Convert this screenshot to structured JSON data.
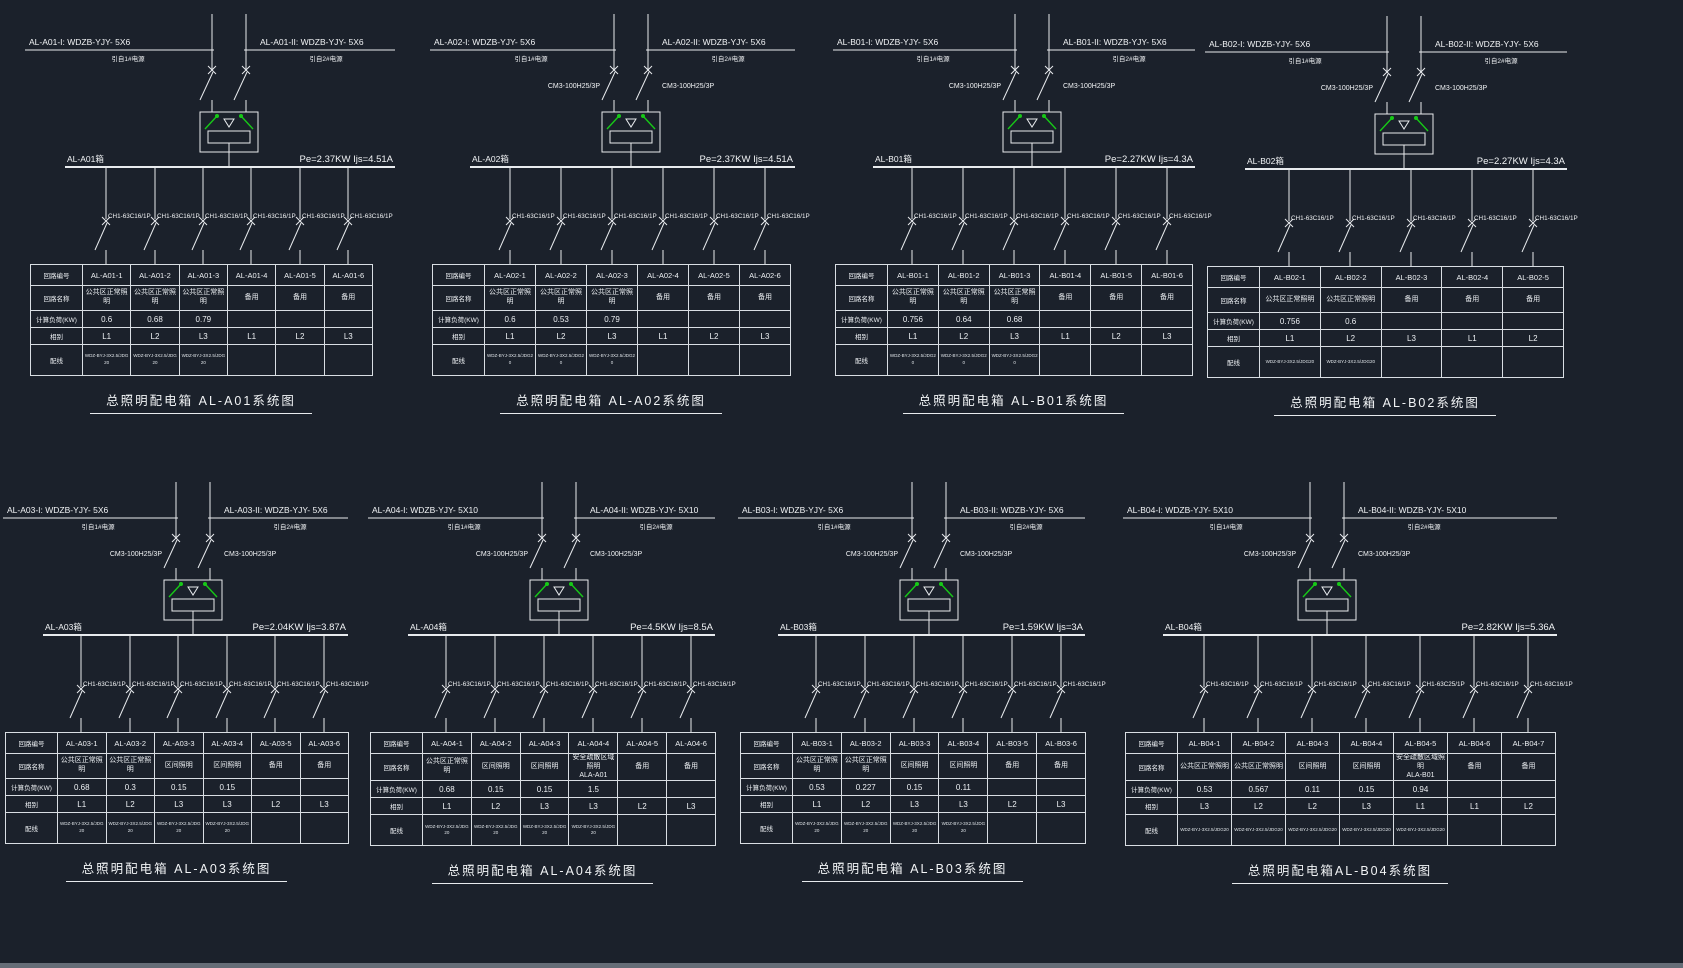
{
  "app": {
    "background": "#1b212b",
    "line_color": "#e8ebee",
    "text_color": "#f2f4f6",
    "switch_green": "#17c917"
  },
  "source_labels": {
    "left": "引自1#电源",
    "right": "引自2#电源"
  },
  "table_row_labels": {
    "circuit_no": "回路编号",
    "circuit_name": "回路名称",
    "load": "计算负荷(KW)",
    "phase": "相别",
    "wiring": "配线"
  },
  "panels": [
    {
      "id": "AL-A01",
      "title": "总照明配电箱 AL-A01系统图",
      "feeder_left": "AL-A01-I: WDZB-YJY- 5X6",
      "feeder_right": "AL-A01-II: WDZB-YJY- 5X6",
      "incoming_breaker": "",
      "bus_label": "AL-A01箱",
      "rating": "Pe=2.37KW Ijs=4.51A",
      "circuits": [
        "AL-A01-1",
        "AL-A01-2",
        "AL-A01-3",
        "AL-A01-4",
        "AL-A01-5",
        "AL-A01-6"
      ],
      "names": [
        "公共区正常照明",
        "公共区正常照明",
        "公共区正常照明",
        "备用",
        "备用",
        "备用"
      ],
      "loads": [
        "0.6",
        "0.68",
        "0.79",
        "",
        "",
        ""
      ],
      "phases": [
        "L1",
        "L2",
        "L3",
        "L1",
        "L2",
        "L3"
      ],
      "wiring": [
        "WDZ-BYJ-3X2.5/JDG20",
        "WDZ-BYJ-3X2.5/JDG20",
        "WDZ-BYJ-3X2.5/JDG20",
        "",
        "",
        ""
      ],
      "branch_breakers": [
        "CH1-63C16/1P",
        "CH1-63C16/1P",
        "CH1-63C16/1P",
        "CH1-63C16/1P",
        "CH1-63C16/1P",
        "CH1-63C16/1P"
      ]
    },
    {
      "id": "AL-A02",
      "title": "总照明配电箱 AL-A02系统图",
      "feeder_left": "AL-A02-I: WDZB-YJY- 5X6",
      "feeder_right": "AL-A02-II: WDZB-YJY- 5X6",
      "incoming_breaker": "CM3-100H25/3P",
      "bus_label": "AL-A02箱",
      "rating": "Pe=2.37KW Ijs=4.51A",
      "circuits": [
        "AL-A02-1",
        "AL-A02-2",
        "AL-A02-3",
        "AL-A02-4",
        "AL-A02-5",
        "AL-A02-6"
      ],
      "names": [
        "公共区正常照明",
        "公共区正常照明",
        "公共区正常照明",
        "备用",
        "备用",
        "备用"
      ],
      "loads": [
        "0.6",
        "0.53",
        "0.79",
        "",
        "",
        ""
      ],
      "phases": [
        "L1",
        "L2",
        "L3",
        "L1",
        "L2",
        "L3"
      ],
      "wiring": [
        "WDZ-BYJ-3X2.5/JDG20",
        "WDZ-BYJ-3X2.5/JDG20",
        "WDZ-BYJ-3X2.5/JDG20",
        "",
        "",
        ""
      ],
      "branch_breakers": [
        "CH1-63C16/1P",
        "CH1-63C16/1P",
        "CH1-63C16/1P",
        "CH1-63C16/1P",
        "CH1-63C16/1P",
        "CH1-63C16/1P"
      ]
    },
    {
      "id": "AL-B01",
      "title": "总照明配电箱 AL-B01系统图",
      "feeder_left": "AL-B01-I: WDZB-YJY- 5X6",
      "feeder_right": "AL-B01-II: WDZB-YJY- 5X6",
      "incoming_breaker": "CM3-100H25/3P",
      "bus_label": "AL-B01箱",
      "rating": "Pe=2.27KW Ijs=4.3A",
      "circuits": [
        "AL-B01-1",
        "AL-B01-2",
        "AL-B01-3",
        "AL-B01-4",
        "AL-B01-5",
        "AL-B01-6"
      ],
      "names": [
        "公共区正常照明",
        "公共区正常照明",
        "公共区正常照明",
        "备用",
        "备用",
        "备用"
      ],
      "loads": [
        "0.756",
        "0.64",
        "0.68",
        "",
        "",
        ""
      ],
      "phases": [
        "L1",
        "L2",
        "L3",
        "L1",
        "L2",
        "L3"
      ],
      "wiring": [
        "WDZ-BYJ-3X2.5/JDG20",
        "WDZ-BYJ-3X2.5/JDG20",
        "WDZ-BYJ-3X2.5/JDG20",
        "",
        "",
        ""
      ],
      "branch_breakers": [
        "CH1-63C16/1P",
        "CH1-63C16/1P",
        "CH1-63C16/1P",
        "CH1-63C16/1P",
        "CH1-63C16/1P",
        "CH1-63C16/1P"
      ]
    },
    {
      "id": "AL-B02",
      "title": "总照明配电箱 AL-B02系统图",
      "feeder_left": "AL-B02-I: WDZB-YJY- 5X6",
      "feeder_right": "AL-B02-II: WDZB-YJY- 5X6",
      "incoming_breaker": "CM3-100H25/3P",
      "bus_label": "AL-B02箱",
      "rating": "Pe=2.27KW Ijs=4.3A",
      "circuits": [
        "AL-B02-1",
        "AL-B02-2",
        "AL-B02-3",
        "AL-B02-4",
        "AL-B02-5"
      ],
      "names": [
        "公共区正常照明",
        "公共区正常照明",
        "备用",
        "备用",
        "备用"
      ],
      "loads": [
        "0.756",
        "0.6",
        "",
        "",
        ""
      ],
      "phases": [
        "L1",
        "L2",
        "L3",
        "L1",
        "L2"
      ],
      "wiring": [
        "WDZ-BYJ-3X2.5/JDG20",
        "WDZ-BYJ-3X2.5/JDG20",
        "",
        "",
        ""
      ],
      "branch_breakers": [
        "CH1-63C16/1P",
        "CH1-63C16/1P",
        "CH1-63C16/1P",
        "CH1-63C16/1P",
        "CH1-63C16/1P"
      ]
    },
    {
      "id": "AL-A03",
      "title": "总照明配电箱 AL-A03系统图",
      "feeder_left": "AL-A03-I: WDZB-YJY- 5X6",
      "feeder_right": "AL-A03-II: WDZB-YJY- 5X6",
      "incoming_breaker": "CM3-100H25/3P",
      "bus_label": "AL-A03箱",
      "rating": "Pe=2.04KW Ijs=3.87A",
      "circuits": [
        "AL-A03-1",
        "AL-A03-2",
        "AL-A03-3",
        "AL-A03-4",
        "AL-A03-5",
        "AL-A03-6"
      ],
      "names": [
        "公共区正常照明",
        "公共区正常照明",
        "区间照明",
        "区间照明",
        "备用",
        "备用"
      ],
      "loads": [
        "0.68",
        "0.3",
        "0.15",
        "0.15",
        "",
        ""
      ],
      "phases": [
        "L1",
        "L2",
        "L3",
        "L3",
        "L2",
        "L3"
      ],
      "wiring": [
        "WDZ-BYJ-3X2.5/JDG20",
        "WDZ-BYJ-3X2.5/JDG20",
        "WDZ-BYJ-3X2.5/JDG20",
        "WDZ-BYJ-3X2.5/JDG20",
        "",
        ""
      ],
      "branch_breakers": [
        "CH1-63C16/1P",
        "CH1-63C16/1P",
        "CH1-63C16/1P",
        "CH1-63C16/1P",
        "CH1-63C16/1P",
        "CH1-63C16/1P"
      ]
    },
    {
      "id": "AL-A04",
      "title": "总照明配电箱 AL-A04系统图",
      "feeder_left": "AL-A04-I: WDZB-YJY- 5X10",
      "feeder_right": "AL-A04-II: WDZB-YJY- 5X10",
      "incoming_breaker": "CM3-100H25/3P",
      "bus_label": "AL-A04箱",
      "rating": "Pe=4.5KW Ijs=8.5A",
      "circuits": [
        "AL-A04-1",
        "AL-A04-2",
        "AL-A04-3",
        "AL-A04-4",
        "AL-A04-5",
        "AL-A04-6"
      ],
      "names": [
        "公共区正常照明",
        "区间照明",
        "区间照明",
        "安全疏散区域照明\nALA-A01",
        "备用",
        "备用"
      ],
      "loads": [
        "0.68",
        "0.15",
        "0.15",
        "1.5",
        "",
        ""
      ],
      "phases": [
        "L1",
        "L2",
        "L3",
        "L3",
        "L2",
        "L3"
      ],
      "wiring": [
        "WDZ-BYJ-3X2.5/JDG20",
        "WDZ-BYJ-3X2.5/JDG20",
        "WDZ-BYJ-3X2.5/JDG20",
        "WDZ-BYJ-3X2.5/JDG20",
        "",
        ""
      ],
      "branch_breakers": [
        "CH1-63C16/1P",
        "CH1-63C16/1P",
        "CH1-63C16/1P",
        "CH1-63C16/1P",
        "CH1-63C16/1P",
        "CH1-63C16/1P"
      ]
    },
    {
      "id": "AL-B03",
      "title": "总照明配电箱 AL-B03系统图",
      "feeder_left": "AL-B03-I: WDZB-YJY- 5X6",
      "feeder_right": "AL-B03-II: WDZB-YJY- 5X6",
      "incoming_breaker": "CM3-100H25/3P",
      "bus_label": "AL-B03箱",
      "rating": "Pe=1.59KW Ijs=3A",
      "circuits": [
        "AL-B03-1",
        "AL-B03-2",
        "AL-B03-3",
        "AL-B03-4",
        "AL-B03-5",
        "AL-B03-6"
      ],
      "names": [
        "公共区正常照明",
        "公共区正常照明",
        "区间照明",
        "区间照明",
        "备用",
        "备用"
      ],
      "loads": [
        "0.53",
        "0.227",
        "0.15",
        "0.11",
        "",
        ""
      ],
      "phases": [
        "L1",
        "L2",
        "L3",
        "L3",
        "L2",
        "L3"
      ],
      "wiring": [
        "WDZ-BYJ-3X2.5/JDG20",
        "WDZ-BYJ-3X2.5/JDG20",
        "WDZ-BYJ-3X2.5/JDG20",
        "WDZ-BYJ-3X2.5/JDG20",
        "",
        ""
      ],
      "branch_breakers": [
        "CH1-63C16/1P",
        "CH1-63C16/1P",
        "CH1-63C16/1P",
        "CH1-63C16/1P",
        "CH1-63C16/1P",
        "CH1-63C16/1P"
      ]
    },
    {
      "id": "AL-B04",
      "title": "总照明配电箱AL-B04系统图",
      "feeder_left": "AL-B04-I: WDZB-YJY- 5X10",
      "feeder_right": "AL-B04-II: WDZB-YJY- 5X10",
      "incoming_breaker": "CM3-100H25/3P",
      "bus_label": "AL-B04箱",
      "rating": "Pe=2.82KW Ijs=5.36A",
      "circuits": [
        "AL-B04-1",
        "AL-B04-2",
        "AL-B04-3",
        "AL-B04-4",
        "AL-B04-5",
        "AL-B04-6",
        "AL-B04-7"
      ],
      "names": [
        "公共区正常照明",
        "公共区正常照明",
        "区间照明",
        "区间照明",
        "安全疏散区域照明\nALA-B01",
        "备用",
        "备用"
      ],
      "loads": [
        "0.53",
        "0.567",
        "0.11",
        "0.15",
        "0.94",
        "",
        ""
      ],
      "phases": [
        "L3",
        "L2",
        "L2",
        "L3",
        "L1",
        "L1",
        "L2"
      ],
      "wiring": [
        "WDZ-BYJ-3X2.5/JDG20",
        "WDZ-BYJ-3X2.5/JDG20",
        "WDZ-BYJ-3X2.5/JDG20",
        "WDZ-BYJ-3X2.5/JDG20",
        "WDZ-BYJ-3X2.5/JDG20",
        "",
        ""
      ],
      "branch_breakers": [
        "CH1-63C16/1P",
        "CH1-63C16/1P",
        "CH1-63C16/1P",
        "CH1-63C16/1P",
        "CH1-63C25/1P",
        "CH1-63C16/1P",
        "CH1-63C16/1P"
      ]
    }
  ]
}
